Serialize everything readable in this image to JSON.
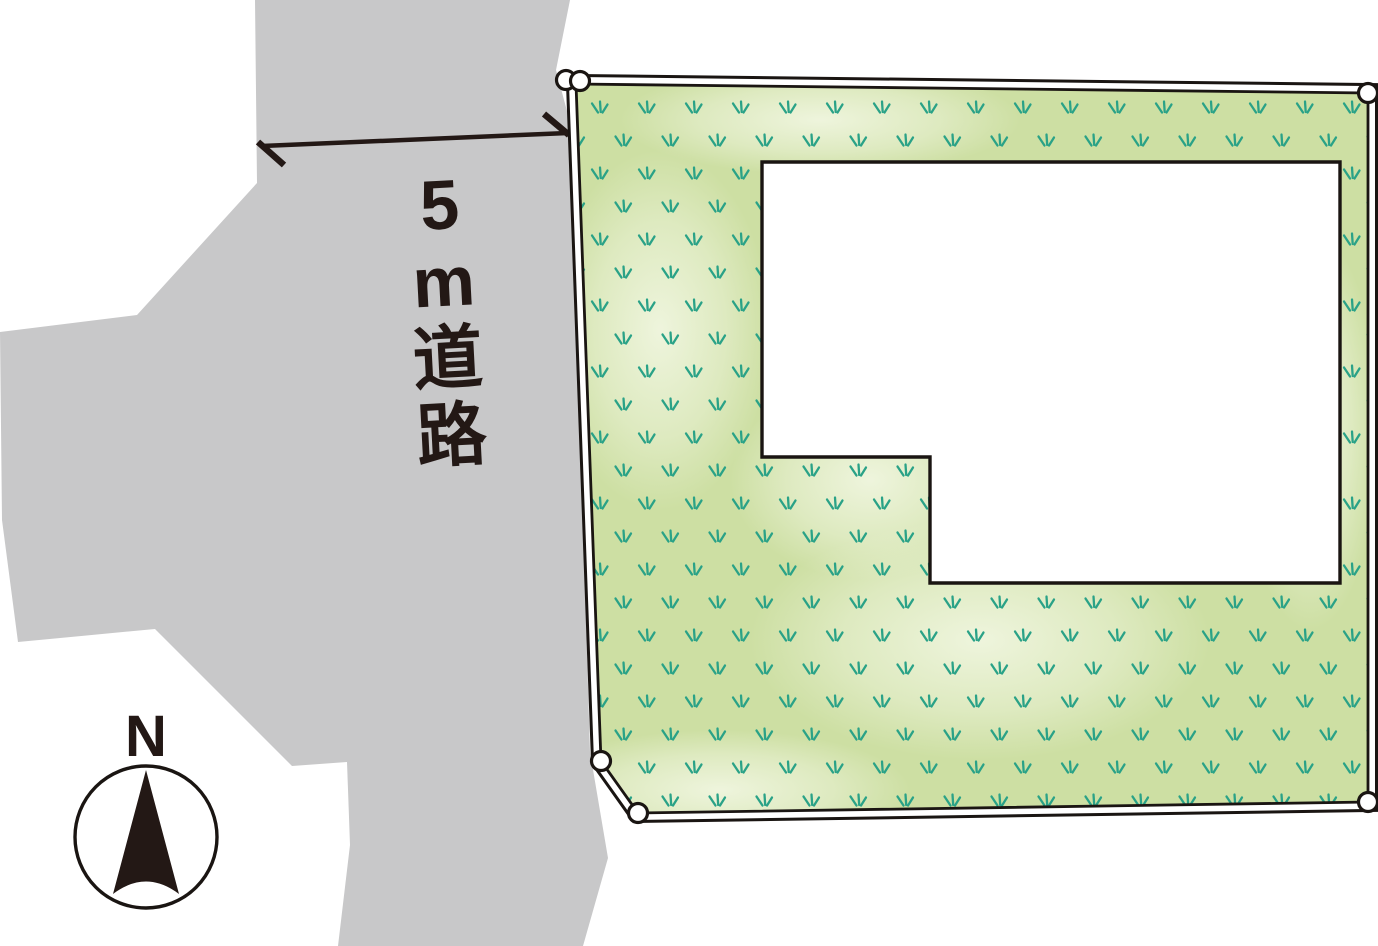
{
  "diagram": {
    "type": "real-estate site plan",
    "colors": {
      "road_gray": "#c8c8c9",
      "ink": "#231815",
      "outline_black": "#1a1512",
      "grass_base": "#cddfa3",
      "grass_light": "#f2f7e3",
      "grass_tuft": "#2aa287",
      "marker_fill": "#ffffff"
    }
  },
  "road": {
    "label": "5m道路",
    "label_chars": [
      "5",
      "m",
      "道",
      "路"
    ],
    "width_meters": 5
  },
  "compass": {
    "label": "N"
  }
}
